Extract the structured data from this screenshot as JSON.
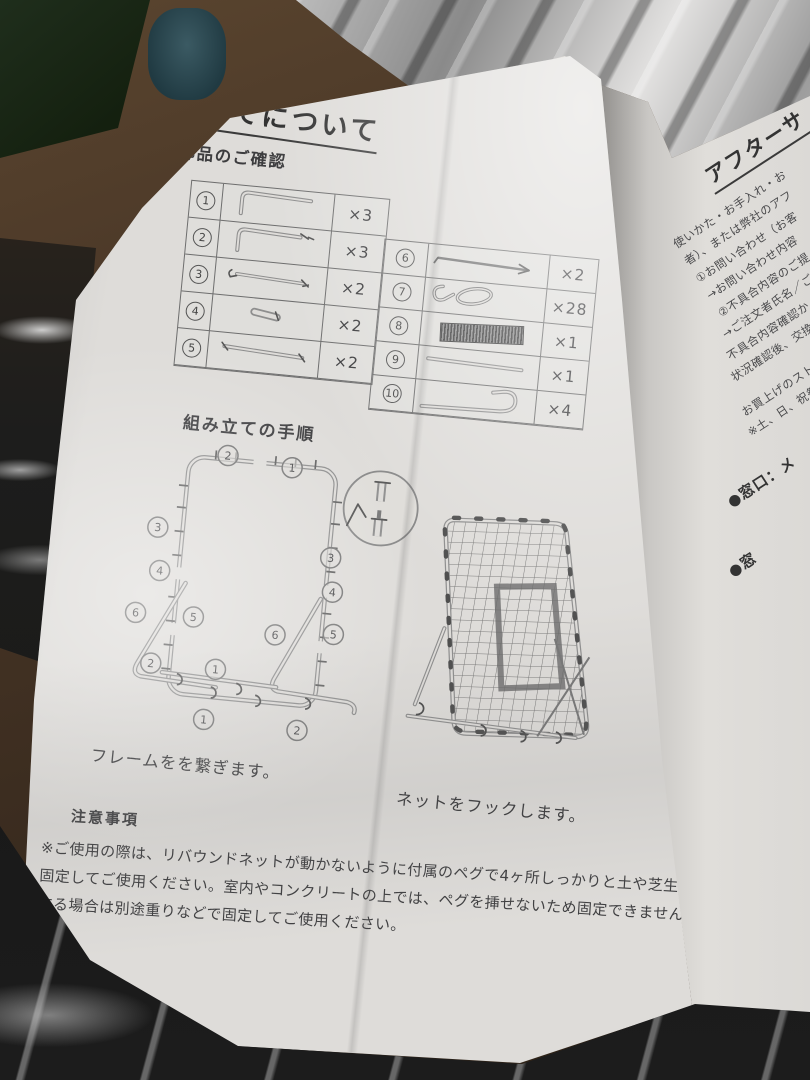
{
  "colors": {
    "paper": "#dedcd9",
    "ink": "#3d3d3f",
    "table_wood": "#4a3727"
  },
  "page": {
    "title": "組み立てについて",
    "parts_heading": "各部品のご確認",
    "steps_heading": "組み立ての手順",
    "captions": {
      "frame": "フレームをを繋ぎます。",
      "net": "ネットをフックします。"
    },
    "notes": {
      "heading": "注意事項",
      "body": "※ご使用の際は、リバウンドネットが動かないように付属のペグで4ヶ所しっかりと土や芝生の地面に固定してご使用ください。室内やコンクリートの上では、ペグを挿せないため固定できません。使用する場合は別途重りなどで固定してご使用ください。"
    }
  },
  "parts_table": {
    "left_rows": [
      {
        "num": "1",
        "icon": "corner-tube",
        "qty": "×3"
      },
      {
        "num": "2",
        "icon": "corner-tube-with-joint",
        "qty": "×3"
      },
      {
        "num": "3",
        "icon": "straight-tube-with-pins",
        "qty": "×2"
      },
      {
        "num": "4",
        "icon": "short-connector",
        "qty": "×2"
      },
      {
        "num": "5",
        "icon": "long-tube",
        "qty": "×2"
      }
    ],
    "right_rows": [
      {
        "num": "6",
        "icon": "rod-with-arrow",
        "qty": "×2"
      },
      {
        "num": "7",
        "icon": "loop-hook",
        "qty": "×28"
      },
      {
        "num": "8",
        "icon": "net-roll",
        "qty": "×1"
      },
      {
        "num": "9",
        "icon": "thin-rod",
        "qty": "×1"
      },
      {
        "num": "10",
        "icon": "j-hook",
        "qty": "×4"
      }
    ]
  },
  "frame_diagram": {
    "markers": [
      "2",
      "1",
      "3",
      "3",
      "4",
      "4",
      "6",
      "5",
      "6",
      "5",
      "2",
      "1",
      "1",
      "2"
    ]
  },
  "side_column": {
    "title": "アフターサ",
    "lines": [
      "使いかた・お手入れ・お",
      "者）、または弊社のアフ",
      "①お問い合わせ（お客",
      "→お問い合わせ内容",
      "②不具合内容のご提",
      "→ご注文者氏名／ご",
      "不具合内容確認か",
      "状況確認後、交換",
      "お買上げのストア",
      "※土、日、祝祭日"
    ],
    "contact": "●窓口：メ",
    "contact2": "●窓"
  }
}
